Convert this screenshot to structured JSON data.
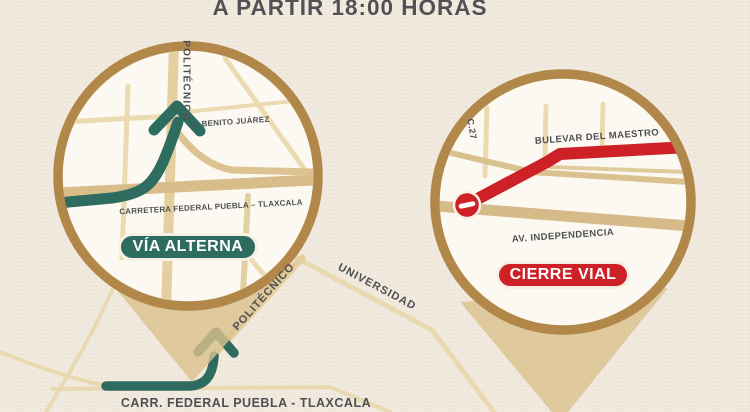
{
  "title": "A PARTIR 18:00 HORAS",
  "left_inset": {
    "badge_label": "VÍA ALTERNA",
    "road_labels": {
      "politecnico": "POLITÉCNICO",
      "benito_juarez": "C. BENITO JUÁREZ",
      "carretera": "CARRETERA FEDERAL PUEBLA – TLAXCALA"
    }
  },
  "right_inset": {
    "badge_label": "CIERRE VIAL",
    "road_labels": {
      "c27": "C.27",
      "bulevar_maestro": "BULEVAR DEL MAESTRO",
      "independencia": "AV. INDEPENDENCIA"
    }
  },
  "base_map": {
    "road_labels": {
      "politecnico": "POLITÉCNICO",
      "universidad": "UNIVERSIDAD",
      "carretera": "CARR. FEDERAL PUEBLA - TLAXCALA"
    }
  },
  "icons": {
    "no_entry": "no-entry-sign",
    "route_arrow_left_inset": "route-arrow",
    "route_arrow_base_map": "route-arrow"
  },
  "colors": {
    "background": "#f1eade",
    "circle_ring_gold": "#b1874a",
    "inset_fill": "#fcf9f2",
    "road_tan": "#ecdbb0",
    "road_dark_tan": "#d8bd8b",
    "route_teal": "#2f6c60",
    "closure_red": "#cd2127",
    "label_gray": "#4f5054",
    "callout_tan": "#dcc28c",
    "badge_outline_cream": "#f6f0e4"
  }
}
